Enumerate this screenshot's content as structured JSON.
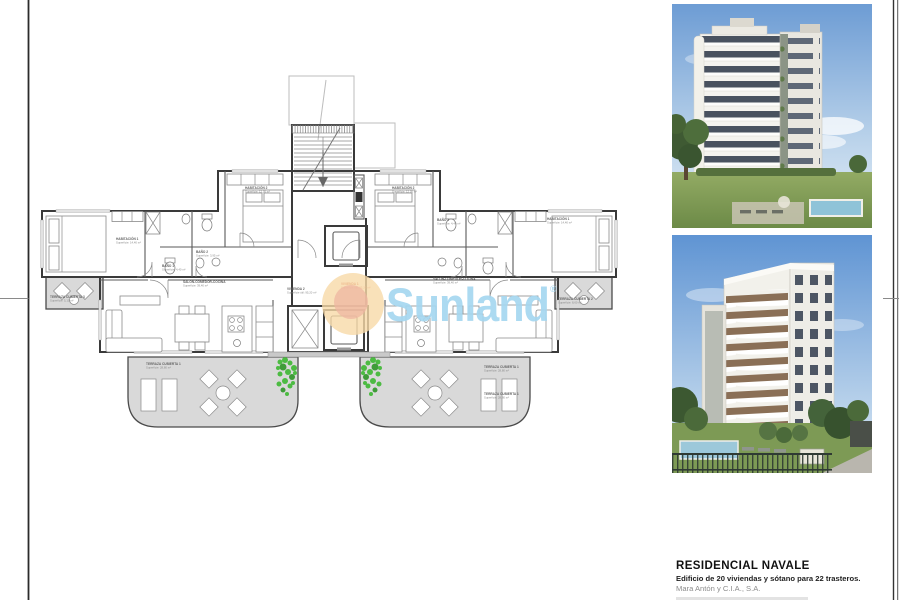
{
  "project": {
    "title": "RESIDENCIAL NAVALE",
    "subtitle": "Edificio de 20 viviendas y sótano para 22 trasteros.",
    "company": "Mara Antón y C.I.A., S.A."
  },
  "watermark": {
    "brand": "Sunland",
    "registered": "®"
  },
  "colors": {
    "watermark_text": "#a6d7f0",
    "sun_outer": "#f7d9a8",
    "sun_inner": "#eeb5a2",
    "terrace_fill": "#d9d9d9",
    "plant_green": "#3db832",
    "highlight_red": "#c0392b"
  },
  "plan": {
    "labels": {
      "hab1L": {
        "n": "HABITACIÓN 1",
        "a": "Superficie: 14,40 m²"
      },
      "bano1L": {
        "n": "BAÑO 1",
        "a": "Superficie: 4,40 m²"
      },
      "bano2L": {
        "n": "BAÑO 2",
        "a": "Superficie: 3,95 m²"
      },
      "hab2L": {
        "n": "HABITACIÓN 2",
        "a": "Superficie: 12,05 m²"
      },
      "salonL": {
        "n": "SALÓN-COMEDOR-COCINA",
        "a": "Superficie: 39,40 m²"
      },
      "terr1L": {
        "n": "TERRAZA CUBIERTA 1",
        "a": "Superficie: 28,80 m²"
      },
      "terr3L": {
        "n": "TERRAZA CUBIERTA 3",
        "a": "Superficie: 5,10 m²"
      },
      "viv2": {
        "n": "VIVIENDA 2",
        "a": "Superficie útil: 95,20 m²"
      },
      "viv1": {
        "n": "VIVIENDA 1",
        "a": "Superficie útil: 95,20 m²"
      },
      "hab2R": {
        "n": "HABITACIÓN 2",
        "a": "Superficie: 12,05 m²"
      },
      "bano1R": {
        "n": "BAÑO 1",
        "a": "Superficie: 4,40 m²"
      },
      "hab1R": {
        "n": "HABITACIÓN 1",
        "a": "Superficie: 14,40 m²"
      },
      "salonR": {
        "n": "SALÓN-COMEDOR-COCINA",
        "a": "Superficie: 39,40 m²"
      },
      "terr2R": {
        "n": "TERRAZA CUBIERTA 2",
        "a": "Superficie: 8,60 m²"
      },
      "terr1Ra": {
        "n": "TERRAZA CUBIERTA 1",
        "a": "Superficie: 28,80 m²"
      },
      "terr1Rb": {
        "n": "TERRAZA CUBIERTA 1",
        "a": "Superficie: 28,80 m²"
      }
    }
  }
}
